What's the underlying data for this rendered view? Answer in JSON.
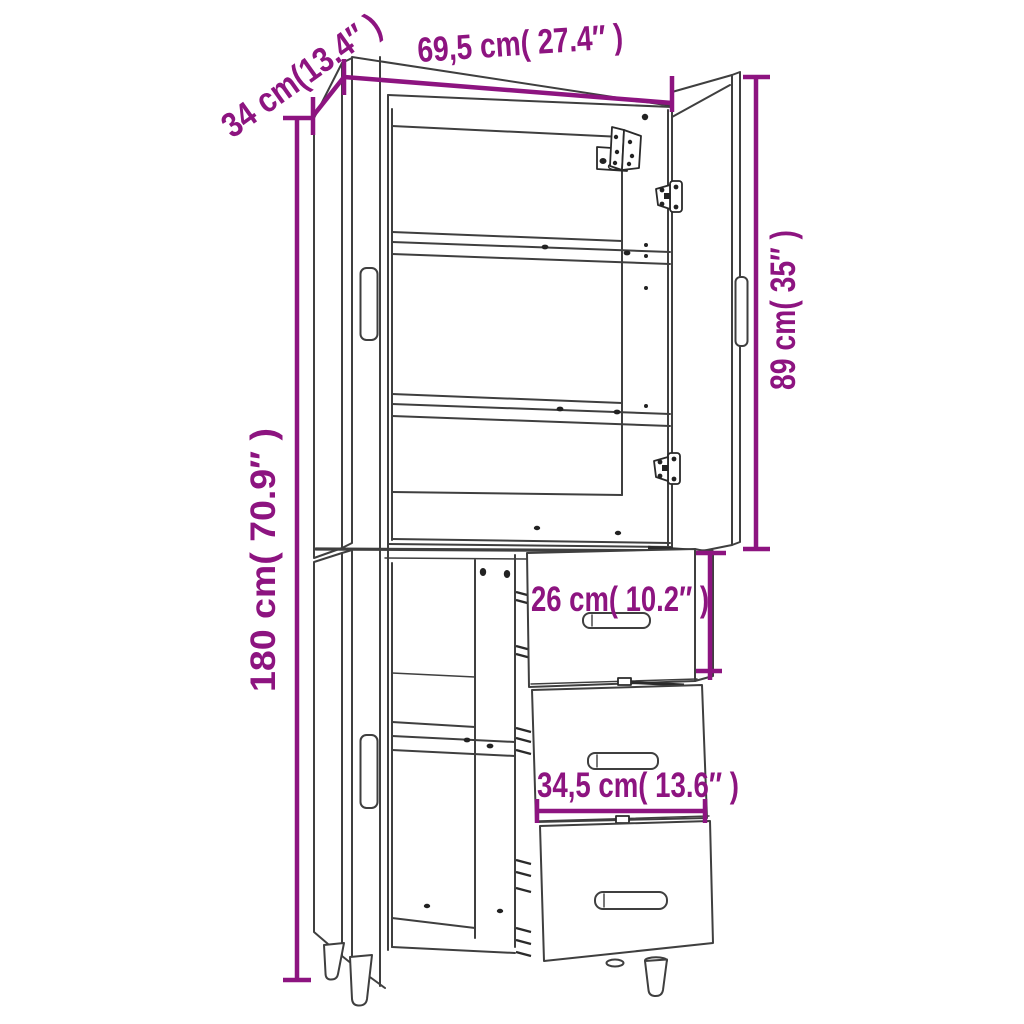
{
  "diagram": {
    "title": "highboard-dimension-diagram",
    "product": "Highboard cabinet with two open upper doors and shelves, lower open door and three pulled-out drawers on tapered legs",
    "colors": {
      "dimension": "#8D1480",
      "outline": "#3F3F3F",
      "background": "#FFFFFF"
    },
    "dimensions": {
      "width": "69,5 cm( 27.4″ )",
      "depth": "34 cm(13.4″ )",
      "upper_door_height": "89 cm( 35″ )",
      "total_height": "180 cm( 70.9″ )",
      "drawer_front_height": "26 cm( 10.2″ )",
      "drawer_front_width": "34,5 cm( 13.6″ )"
    }
  }
}
